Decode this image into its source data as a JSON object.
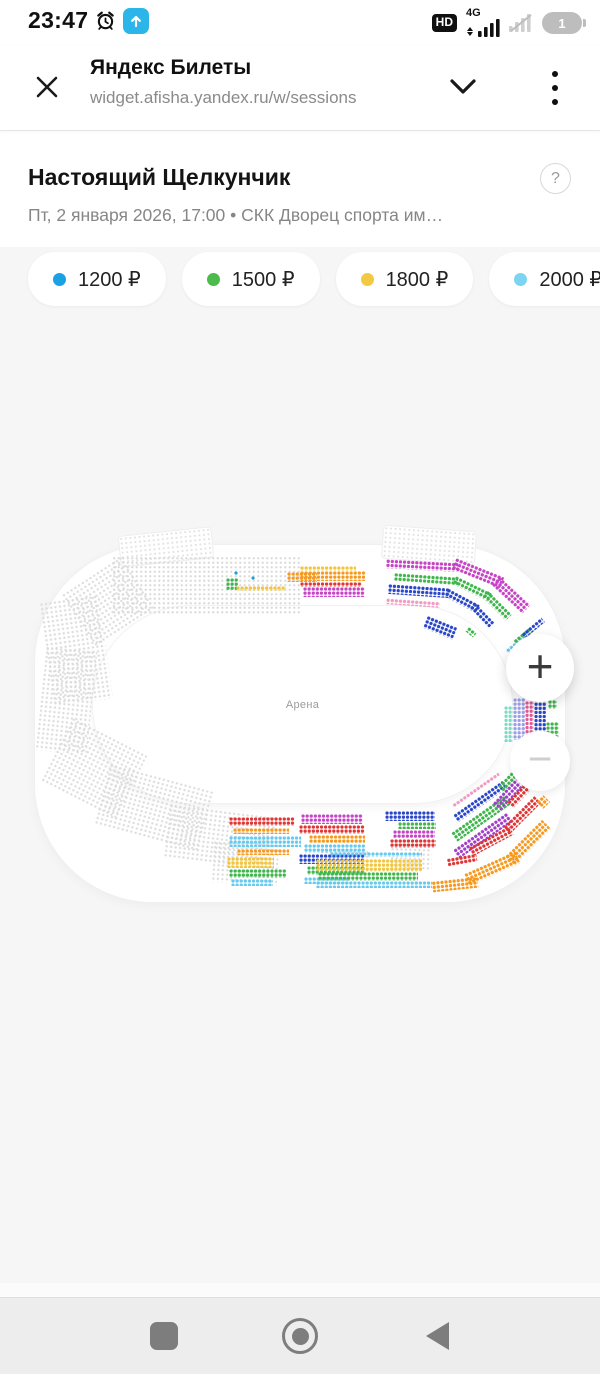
{
  "status_bar": {
    "time": "23:47",
    "hd_badge": "HD",
    "network": "4G",
    "battery_level": "1"
  },
  "browser_header": {
    "title": "Яндекс Билеты",
    "url": "widget.afisha.yandex.ru/w/sessions"
  },
  "event": {
    "title": "Настоящий Щелкунчик",
    "subtitle": "Пт, 2 января 2026, 17:00  •  СКК Дворец спорта им…",
    "help_label": "?"
  },
  "price_legend": [
    {
      "label": "1200 ₽",
      "color": "#1ba1e2"
    },
    {
      "label": "1500 ₽",
      "color": "#4cbb4c"
    },
    {
      "label": "1800 ₽",
      "color": "#f3c843"
    },
    {
      "label": "2000 ₽",
      "color": "#7dd4f0"
    }
  ],
  "map": {
    "arena_label": "Арена",
    "zoom_in": "+",
    "zoom_out": "−",
    "colors": {
      "blu": "#18a0e4",
      "grn": "#3fb54c",
      "yel": "#f2c53d",
      "cyn": "#66c9ef",
      "mag": "#c544c5",
      "pur": "#a13fc9",
      "nvy": "#2a46c8",
      "pnk": "#f29ac2",
      "red": "#df3535",
      "org": "#f6991f",
      "lav": "#9c9ee9",
      "dpk": "#e25a92",
      "tea": "#7adcc4",
      "gry": "#dcdcdc"
    },
    "panels": [
      [
        120,
        532,
        92,
        30,
        -6
      ],
      [
        383,
        529,
        92,
        32,
        4
      ]
    ],
    "sections": [
      [
        112,
        556,
        188,
        58,
        "gry",
        0
      ],
      [
        72,
        570,
        72,
        62,
        "gry",
        -33
      ],
      [
        46,
        598,
        60,
        105,
        "gry",
        -8
      ],
      [
        40,
        648,
        52,
        105,
        "gry",
        6
      ],
      [
        52,
        732,
        84,
        72,
        "gry",
        27
      ],
      [
        100,
        776,
        108,
        64,
        "gry",
        15
      ],
      [
        166,
        810,
        108,
        54,
        "gry",
        7
      ],
      [
        212,
        842,
        66,
        42,
        "gry",
        3
      ],
      [
        320,
        850,
        50,
        8,
        "gry",
        0
      ],
      [
        390,
        843,
        42,
        26,
        "gry",
        2
      ],
      [
        234,
        571,
        4,
        4,
        "blu",
        0
      ],
      [
        251,
        576,
        4,
        4,
        "blu",
        0
      ],
      [
        226,
        578,
        12,
        12,
        "grn",
        0
      ],
      [
        236,
        586,
        42,
        5,
        "yel",
        0
      ],
      [
        277,
        586,
        9,
        5,
        "yel",
        0
      ],
      [
        287,
        572,
        30,
        10,
        "org",
        0
      ],
      [
        300,
        566,
        56,
        5,
        "yel",
        0
      ],
      [
        300,
        571,
        66,
        10,
        "org",
        0
      ],
      [
        300,
        582,
        62,
        5,
        "red",
        0
      ],
      [
        303,
        587,
        62,
        10,
        "mag",
        0
      ],
      [
        386,
        561,
        72,
        9,
        "mag",
        3
      ],
      [
        452,
        567,
        52,
        12,
        "mag",
        22
      ],
      [
        490,
        589,
        42,
        12,
        "mag",
        43
      ],
      [
        394,
        575,
        64,
        8,
        "grn",
        4
      ],
      [
        452,
        584,
        40,
        9,
        "grn",
        26
      ],
      [
        480,
        601,
        34,
        9,
        "grn",
        45
      ],
      [
        388,
        586,
        62,
        10,
        "nvy",
        4
      ],
      [
        444,
        596,
        36,
        9,
        "nvy",
        28
      ],
      [
        468,
        611,
        28,
        8,
        "nvy",
        46
      ],
      [
        386,
        600,
        54,
        6,
        "pnk",
        4
      ],
      [
        424,
        621,
        32,
        13,
        "nvy",
        22
      ],
      [
        466,
        629,
        10,
        6,
        "grn",
        40
      ],
      [
        504,
        641,
        26,
        5,
        "cyn",
        -40
      ],
      [
        512,
        633,
        22,
        5,
        "grn",
        -40
      ],
      [
        520,
        625,
        26,
        6,
        "nvy",
        -40
      ],
      [
        504,
        706,
        9,
        36,
        "tea",
        0
      ],
      [
        513,
        698,
        12,
        42,
        "lav",
        0
      ],
      [
        525,
        701,
        9,
        34,
        "dpk",
        0
      ],
      [
        534,
        694,
        12,
        46,
        "nvy",
        0
      ],
      [
        548,
        700,
        9,
        9,
        "grn",
        0
      ],
      [
        546,
        722,
        13,
        18,
        "grn",
        0
      ],
      [
        448,
        788,
        56,
        4,
        "pnk",
        -35
      ],
      [
        450,
        797,
        60,
        9,
        "nvy",
        -35
      ],
      [
        448,
        813,
        66,
        11,
        "grn",
        -35
      ],
      [
        450,
        830,
        66,
        11,
        "pur",
        -35
      ],
      [
        490,
        787,
        40,
        11,
        "pur",
        -47
      ],
      [
        496,
        775,
        28,
        8,
        "grn",
        -47
      ],
      [
        505,
        789,
        32,
        9,
        "red",
        -47
      ],
      [
        500,
        810,
        44,
        10,
        "red",
        -45
      ],
      [
        468,
        836,
        46,
        10,
        "red",
        -28
      ],
      [
        447,
        856,
        30,
        8,
        "red",
        -10
      ],
      [
        502,
        836,
        52,
        13,
        "org",
        -45
      ],
      [
        464,
        862,
        56,
        13,
        "org",
        -24
      ],
      [
        432,
        879,
        46,
        11,
        "org",
        -6
      ],
      [
        538,
        797,
        10,
        10,
        "org",
        -45
      ],
      [
        229,
        817,
        66,
        9,
        "red",
        0
      ],
      [
        233,
        828,
        56,
        6,
        "org",
        0
      ],
      [
        229,
        836,
        72,
        11,
        "cyn",
        0
      ],
      [
        237,
        849,
        52,
        6,
        "org",
        0
      ],
      [
        227,
        857,
        47,
        11,
        "yel",
        0
      ],
      [
        229,
        869,
        57,
        9,
        "grn",
        0
      ],
      [
        231,
        879,
        42,
        7,
        "cyn",
        0
      ],
      [
        301,
        814,
        62,
        10,
        "mag",
        0
      ],
      [
        299,
        825,
        66,
        9,
        "red",
        0
      ],
      [
        309,
        835,
        56,
        8,
        "org",
        0
      ],
      [
        304,
        844,
        61,
        9,
        "cyn",
        0
      ],
      [
        299,
        854,
        66,
        10,
        "nvy",
        0
      ],
      [
        307,
        866,
        58,
        9,
        "grn",
        0
      ],
      [
        304,
        877,
        46,
        7,
        "cyn",
        0
      ],
      [
        385,
        811,
        50,
        10,
        "nvy",
        0
      ],
      [
        398,
        822,
        38,
        7,
        "grn",
        0
      ],
      [
        393,
        830,
        42,
        8,
        "mag",
        0
      ],
      [
        390,
        839,
        46,
        9,
        "red",
        0
      ],
      [
        330,
        852,
        92,
        5,
        "cyn",
        0
      ],
      [
        316,
        859,
        106,
        13,
        "yel",
        0
      ],
      [
        318,
        872,
        100,
        9,
        "grn",
        0
      ],
      [
        316,
        881,
        116,
        7,
        "cyn",
        0
      ]
    ]
  }
}
